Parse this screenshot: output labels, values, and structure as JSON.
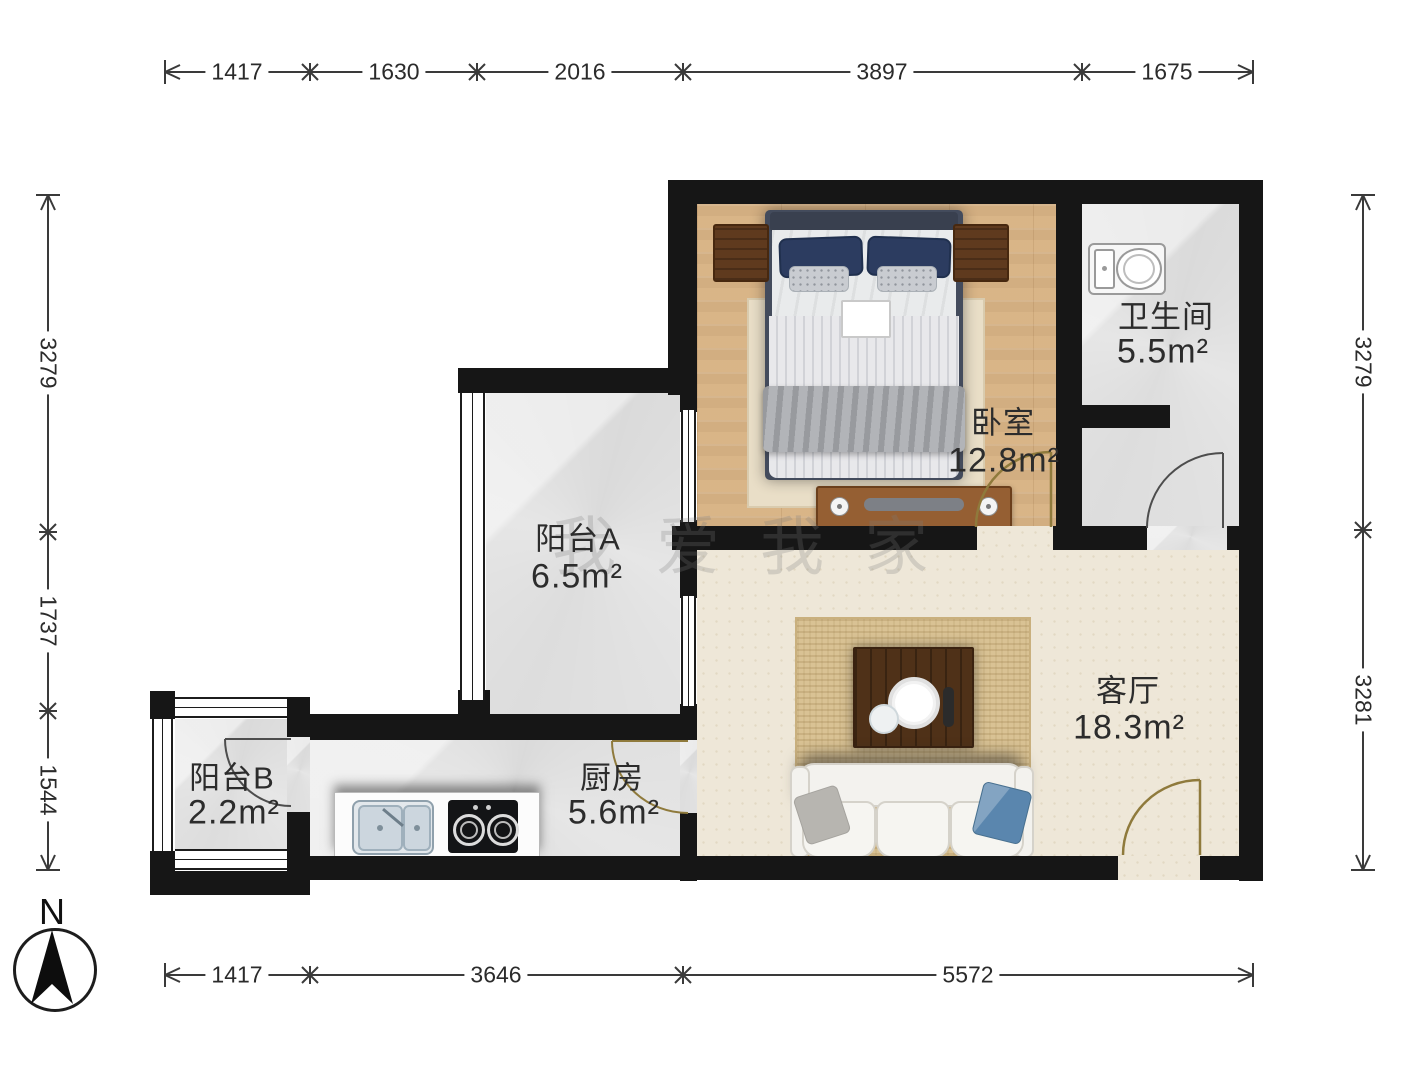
{
  "plan_title": "一室一厅户型图",
  "compass": {
    "label": "N"
  },
  "watermark": "我爱我家",
  "rooms": [
    {
      "id": "bedroom",
      "name": "卧室",
      "area": "12.8m²"
    },
    {
      "id": "bathroom",
      "name": "卫生间",
      "area": "5.5m²"
    },
    {
      "id": "balcony-a",
      "name": "阳台A",
      "area": "6.5m²"
    },
    {
      "id": "living",
      "name": "客厅",
      "area": "18.3m²"
    },
    {
      "id": "kitchen",
      "name": "厨房",
      "area": "5.6m²"
    },
    {
      "id": "balcony-b",
      "name": "阳台B",
      "area": "2.2m²"
    }
  ],
  "dimensions": {
    "top": [
      "1417",
      "1630",
      "2016",
      "3897",
      "1675"
    ],
    "bottom": [
      "1417",
      "3646",
      "5572"
    ],
    "left": [
      "3279",
      "1737",
      "1544"
    ],
    "right": [
      "3279",
      "3281"
    ]
  },
  "colors": {
    "wall": "#161616",
    "wood_floor": "#dcb98c",
    "tile_floor": "#e6e6e6",
    "living_floor": "#eee7d8",
    "door_arc_gold": "#8f7a3c",
    "door_arc_dark": "#4d4d4d",
    "dim_text": "#2b2b2b"
  }
}
